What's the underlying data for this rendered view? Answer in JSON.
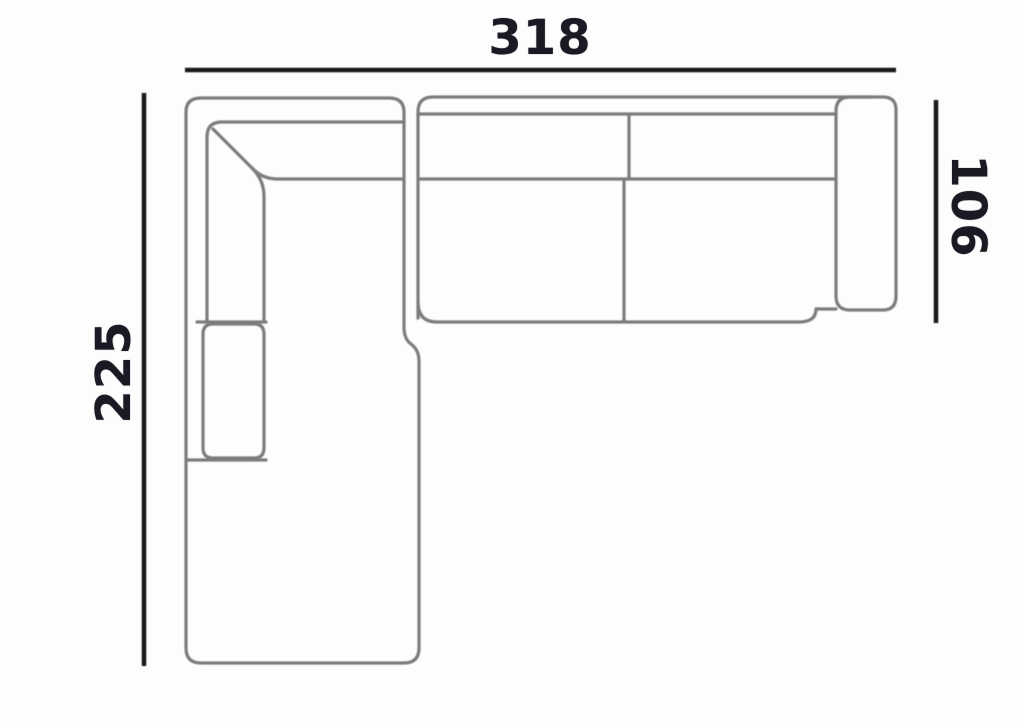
{
  "diagram": {
    "subject": "corner sofa with left chaise, top view dimension drawing",
    "dimensions": {
      "width": {
        "value": "318",
        "position": "top",
        "orientation": "horizontal"
      },
      "left_depth": {
        "value": "225",
        "position": "left",
        "orientation": "vertical, reads bottom-to-top"
      },
      "right_depth": {
        "value": "106",
        "position": "right",
        "orientation": "vertical, reads top-to-bottom"
      }
    },
    "colors": {
      "background": "#fdfdfd",
      "outline": "#7c7c7c",
      "dimension_line": "#191919",
      "label_text": "#1a1a24"
    }
  }
}
